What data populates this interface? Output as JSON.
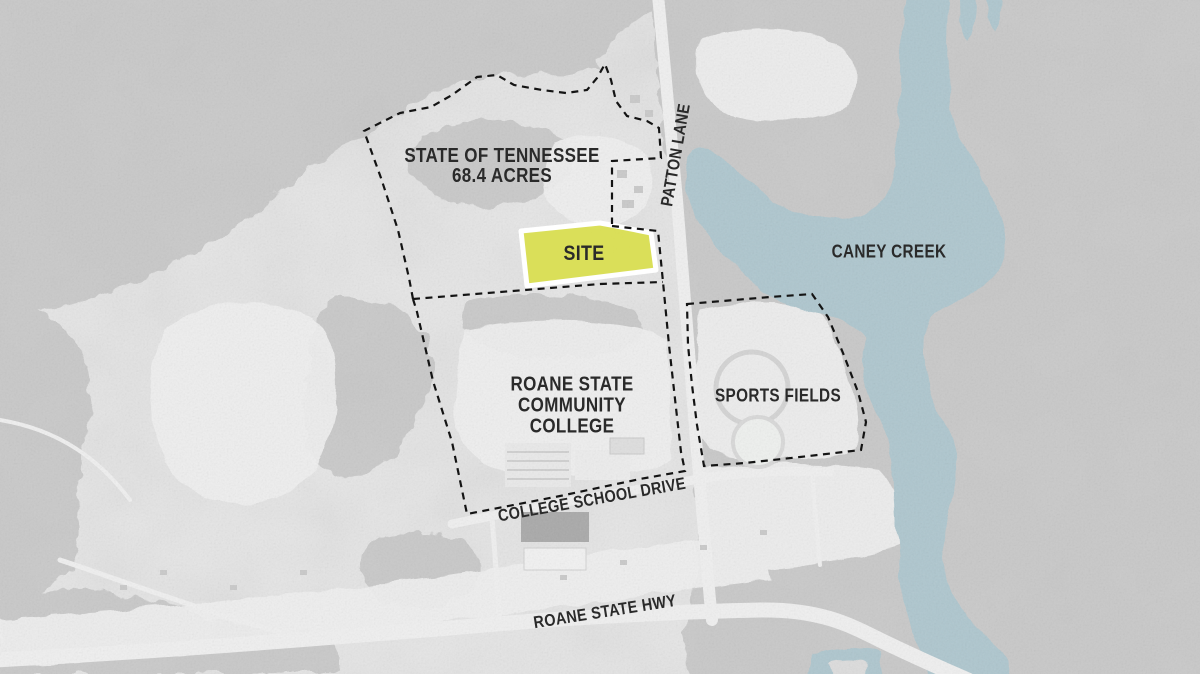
{
  "map_labels": {
    "state_parcel_line1": "STATE OF TENNESSEE",
    "state_parcel_line2": "68.4 ACRES",
    "site": "SITE",
    "creek": "CANEY CREEK",
    "college_line1": "ROANE STATE",
    "college_line2": "COMMUNITY",
    "college_line3": "COLLEGE",
    "sports_fields": "SPORTS FIELDS",
    "road_patton_lane": "PATTON LANE",
    "road_college_school_drive": "COLLEGE SCHOOL DRIVE",
    "road_roane_state_hwy": "ROANE STATE HWY"
  },
  "colors": {
    "water": "#aec6ce",
    "site_fill": "#d9de4d",
    "site_outline": "#ffffff",
    "boundary_dash": "#141414",
    "label_text": "#2a2a2a",
    "land_base": "#e6e6e6",
    "forest": "#bfbfbf",
    "road": "#efefef"
  }
}
